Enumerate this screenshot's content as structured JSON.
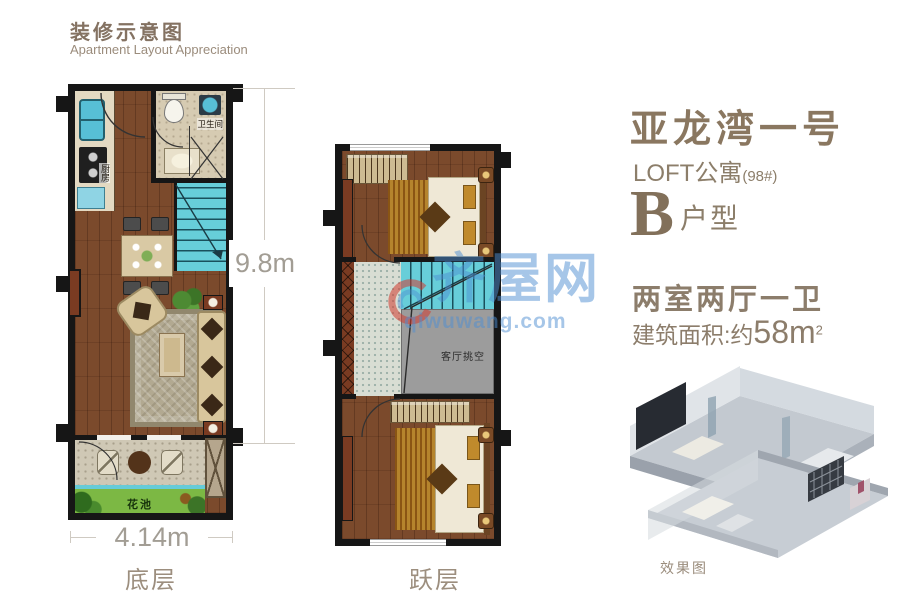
{
  "header": {
    "title": "装修示意图",
    "subtitle": "Apartment Layout Appreciation"
  },
  "info": {
    "project_name": "亚龙湾一号",
    "building_type": "LOFT公寓",
    "building_number": "(98#)",
    "unit_letter": "B",
    "unit_label": "户型",
    "rooms_summary": "两室两厅一卫",
    "area_prefix": "建筑面积:约",
    "area_value": "58",
    "area_unit": "m",
    "area_exponent": "2",
    "render_caption": "效果图"
  },
  "plans": {
    "ground": {
      "caption": "底层",
      "width_dim": "4.14m",
      "depth_dim": "9.8m",
      "rooms": {
        "kitchen": "厨房",
        "bathroom": "卫生间",
        "flower_bed": "花池"
      }
    },
    "upper": {
      "caption": "跃层",
      "rooms": {
        "void": "客厅挑空"
      }
    }
  },
  "watermark": {
    "site_name": "齐屋网",
    "site_domain": "qiwuwang.com"
  },
  "colors": {
    "accent_text": "#8c7d6b",
    "serif_title": "#87755d",
    "dim_text": "#a29d94",
    "watermark_blue": "#4d8ed1",
    "watermark_red": "#d23b2f",
    "stair_cyan": "#67ced9",
    "wood_floor": "#7b4a2c",
    "flower_green": "#7cb844",
    "wall_black": "#161616"
  }
}
